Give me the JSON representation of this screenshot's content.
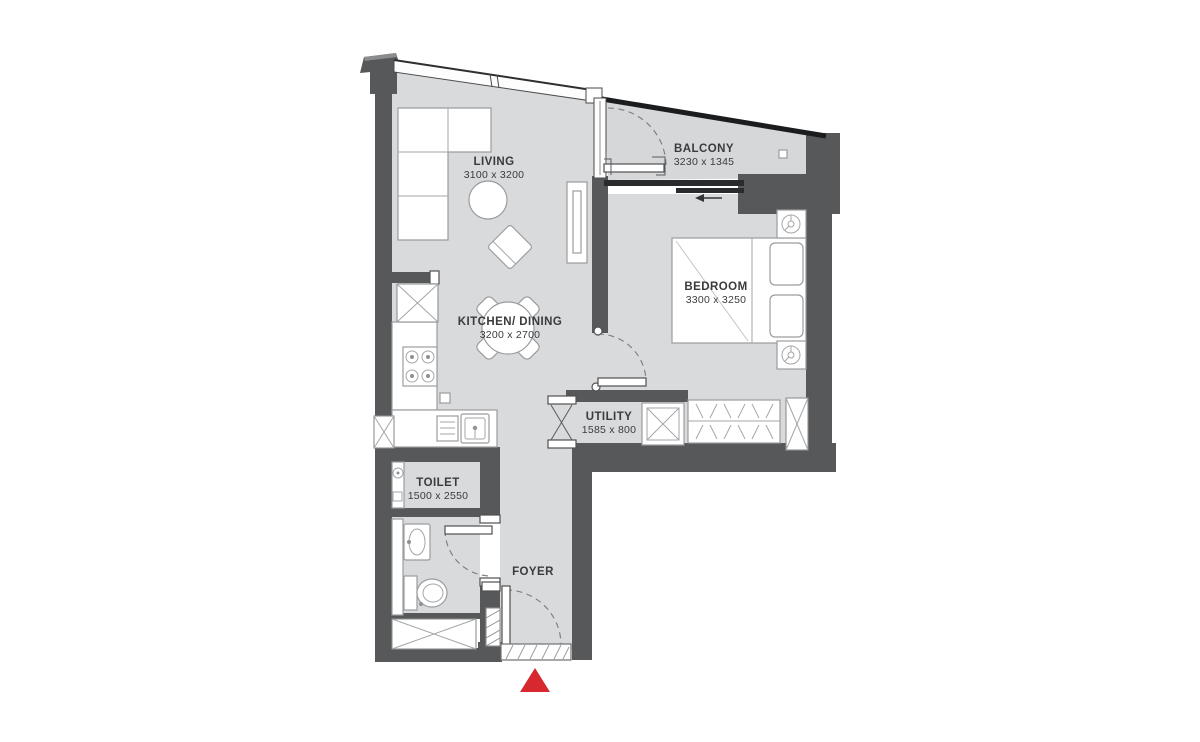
{
  "plan": {
    "rooms": [
      {
        "name": "LIVING",
        "dims": "3100 x 3200"
      },
      {
        "name": "BALCONY",
        "dims": "3230 x 1345"
      },
      {
        "name": "BEDROOM",
        "dims": "3300 x 3250"
      },
      {
        "name": "KITCHEN/ DINING",
        "dims": "3200 x 2700"
      },
      {
        "name": "UTILITY",
        "dims": "1585 x 800"
      },
      {
        "name": "TOILET",
        "dims": "1500 x 2550"
      },
      {
        "name": "FOYER",
        "dims": ""
      }
    ],
    "colors": {
      "wall": "#57585a",
      "floor": "#d9dadb",
      "furniture_outline": "#9b9c9e",
      "label_text": "#3a3b3c",
      "balcony_railing": "#1b1c1e",
      "entrance_marker_red": "#d7282f",
      "background": "#ffffff"
    },
    "icons": [
      "l-shaped-sofa",
      "coffee-table",
      "armchair",
      "tv-unit",
      "fridge",
      "stove-hob",
      "kitchen-sink",
      "dining-table",
      "dining-chair",
      "double-bed",
      "pillow",
      "nightstand-lamp",
      "wardrobe-rail",
      "washing-machine",
      "shower-head",
      "washbasin",
      "wc-toilet",
      "door-swing-arc",
      "sliding-door-arrow",
      "bifold-door",
      "duct-shaft-x",
      "entrance-triangle"
    ]
  }
}
